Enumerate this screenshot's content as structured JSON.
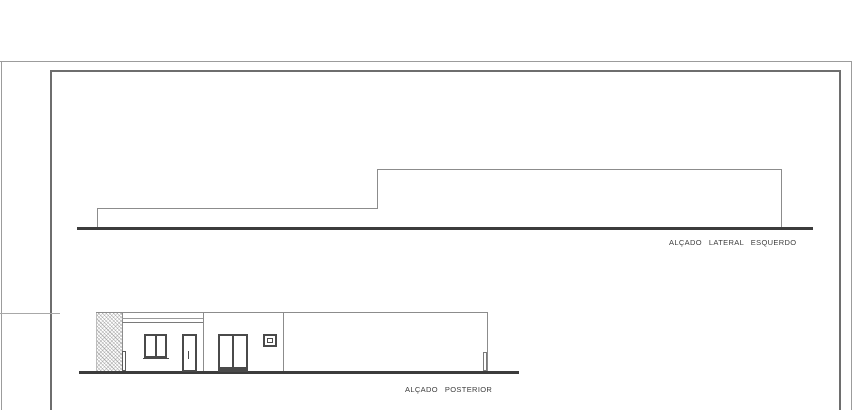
{
  "sheet": {
    "type": "architectural-elevation-drawing"
  },
  "colors": {
    "paper": "#ffffff",
    "border_outer": "#9c9c9c",
    "border_inner": "#6e6e6e",
    "outline": "#8c8c8c",
    "ground": "#3c3c3c",
    "frame_dark": "#4a4a4a",
    "text": "#3c3c3c"
  },
  "elevations": {
    "lateral_esquerdo": {
      "label": "ALÇADO LATERAL ESQUERDO"
    },
    "posterior": {
      "label": "ALÇADO POSTERIOR"
    }
  }
}
